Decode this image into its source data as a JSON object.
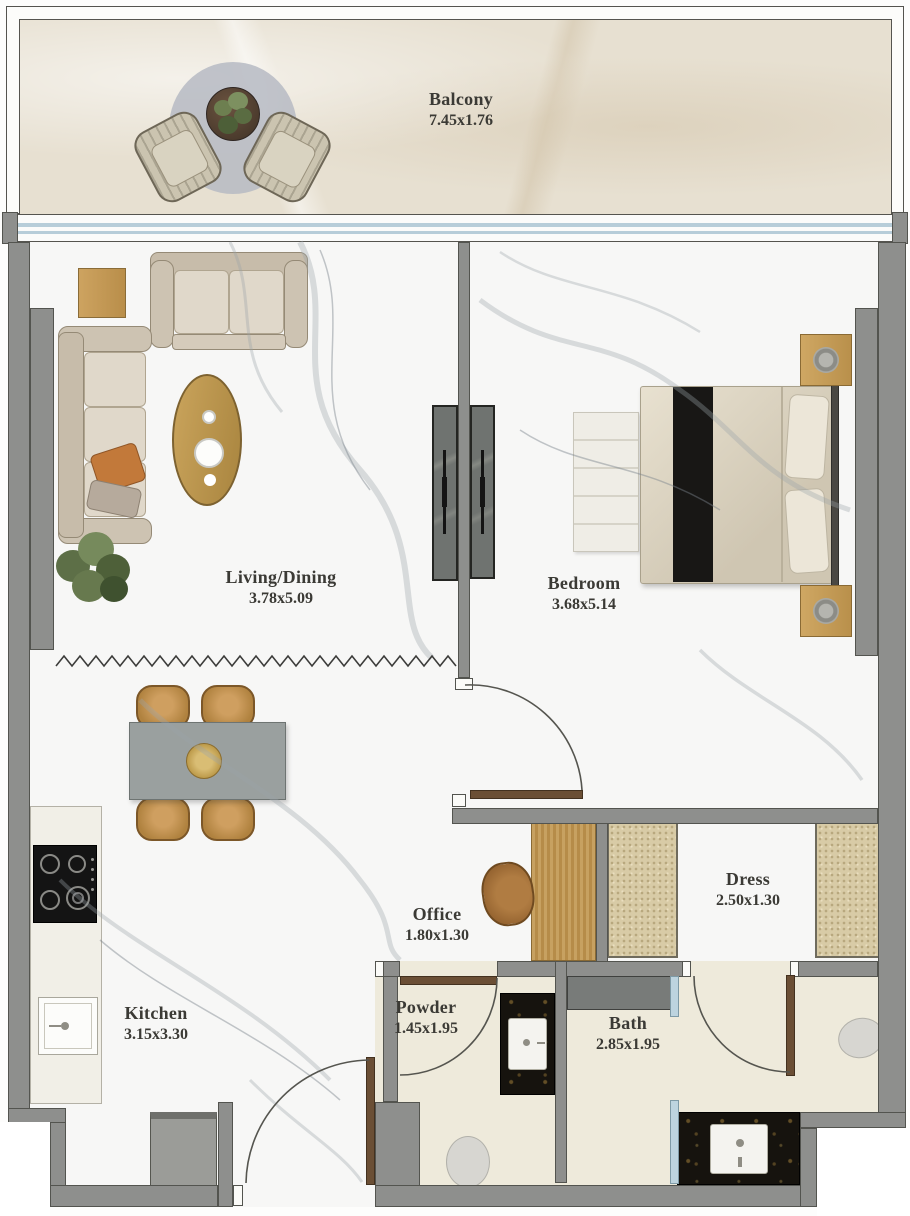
{
  "plan": {
    "rooms": [
      {
        "id": "balcony",
        "label": "Balcony",
        "dims": "7.45x1.76"
      },
      {
        "id": "living",
        "label": "Living/Dining",
        "dims": "3.78x5.09"
      },
      {
        "id": "bedroom",
        "label": "Bedroom",
        "dims": "3.68x5.14"
      },
      {
        "id": "office",
        "label": "Office",
        "dims": "1.80x1.30"
      },
      {
        "id": "dress",
        "label": "Dress",
        "dims": "2.50x1.30"
      },
      {
        "id": "kitchen",
        "label": "Kitchen",
        "dims": "3.15x3.30"
      },
      {
        "id": "powder",
        "label": "Powder",
        "dims": "1.45x1.95"
      },
      {
        "id": "bath",
        "label": "Bath",
        "dims": "2.85x1.95"
      }
    ],
    "colors": {
      "wall_gray": "#8e8f8d",
      "glass_blue": "#bdd4df",
      "wood_brass": "#c29a5c",
      "black_marble": "#16130e",
      "floor_marble_white": "#f6f6f5",
      "floor_balcony_beige": "#e7e0d1",
      "floor_bath_cream": "#eeeadb"
    }
  }
}
